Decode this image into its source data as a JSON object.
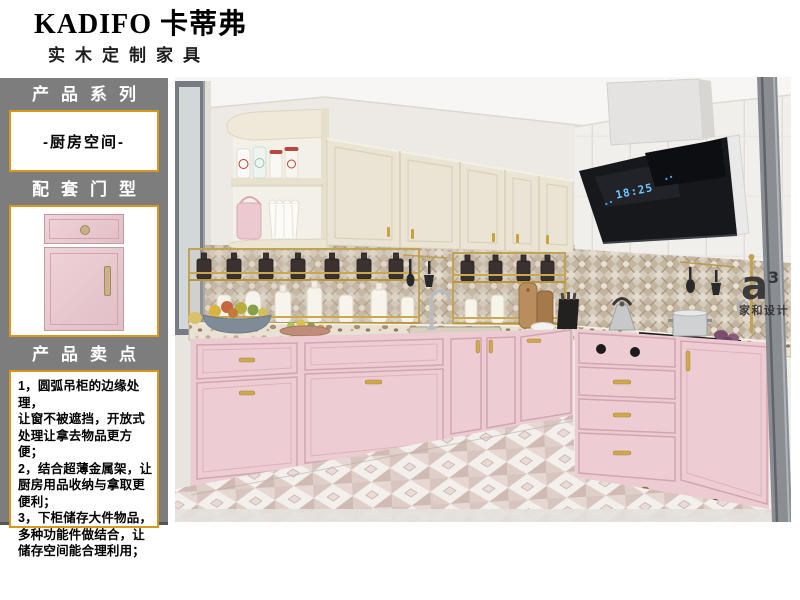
{
  "brand": {
    "logo": "KADIFO 卡蒂弗",
    "tagline": "实木定制家具"
  },
  "sidebar": {
    "series_label": "产品系列",
    "series_value": "-厨房空间-",
    "door_label": "配套门型",
    "selling_label": "产品卖点",
    "selling_lines": [
      "1，圆弧吊柜的边缘处理，",
      "让窗不被遮挡，开放式",
      "处理让拿去物品更方便；",
      "2，结合超薄金属架，让",
      "厨房用品收纳与拿取更",
      "便利；",
      "3，下柜储存大件物品，",
      "多种功能件做结合，让",
      "储存空间能合理利用；"
    ]
  },
  "kitchen": {
    "hood_display": "18:25",
    "watermark_mark": "a",
    "watermark_sup": "3",
    "watermark_studio": "家和设计"
  },
  "colors": {
    "accent_gold": "#d8991a",
    "sidebar_gray": "#7d7d7d",
    "cabinet_pink": "#eccbd2",
    "cabinet_cream": "#e9e4d3"
  }
}
